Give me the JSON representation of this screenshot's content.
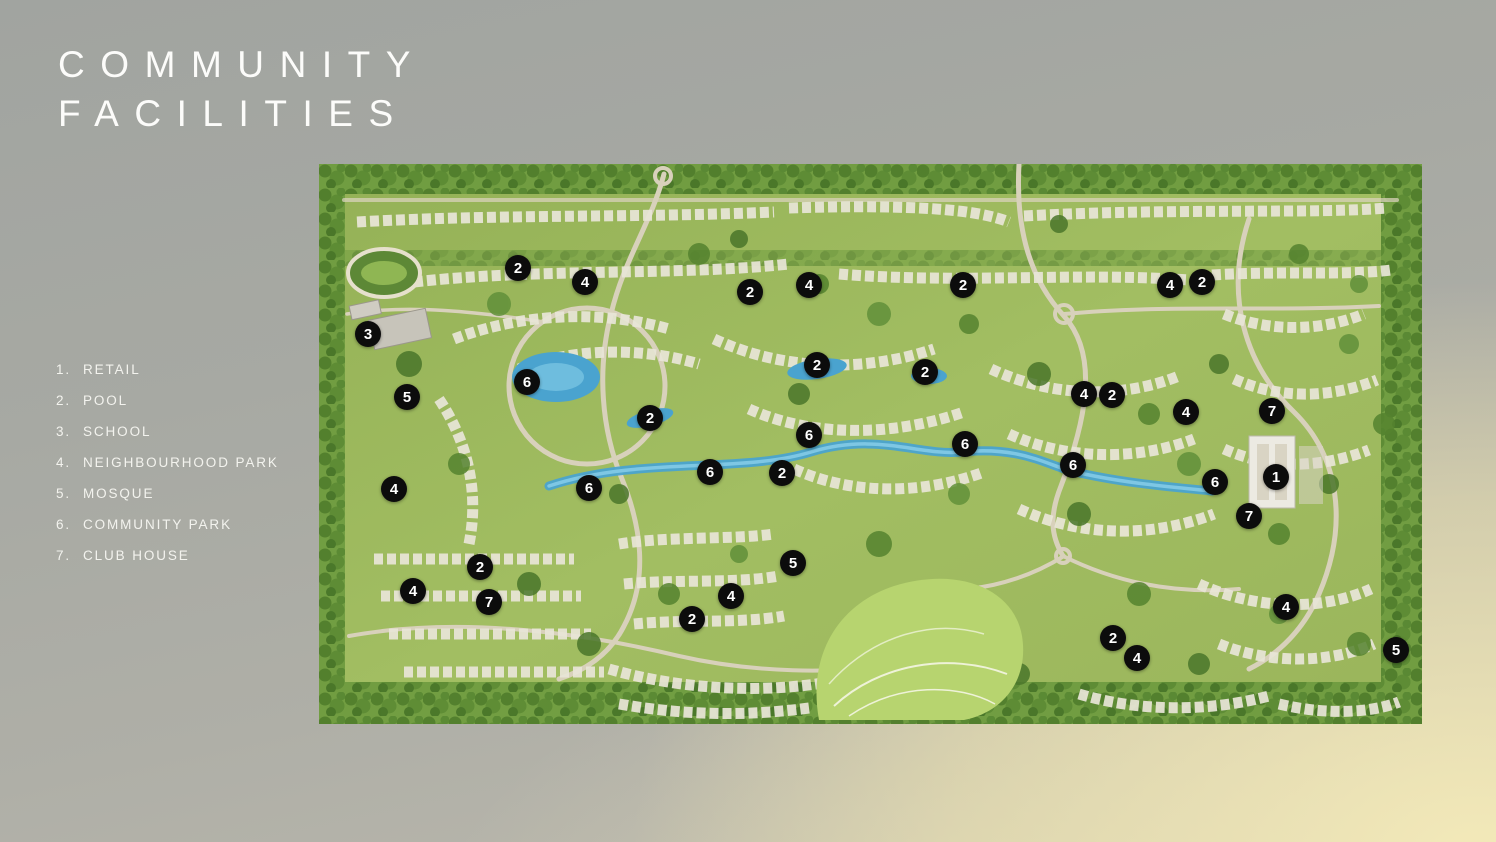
{
  "slide": {
    "title_line1": "COMMUNITY",
    "title_line2": "FACILITIES"
  },
  "legend": {
    "items": [
      {
        "num": "1",
        "label": "RETAIL"
      },
      {
        "num": "2",
        "label": "POOL"
      },
      {
        "num": "3",
        "label": "SCHOOL"
      },
      {
        "num": "4",
        "label": "NEIGHBOURHOOD PARK"
      },
      {
        "num": "5",
        "label": "MOSQUE"
      },
      {
        "num": "6",
        "label": "COMMUNITY PARK"
      },
      {
        "num": "7",
        "label": "CLUB HOUSE"
      }
    ]
  },
  "map": {
    "description": "Aerial masterplan render of the community with numbered facility markers",
    "markers": [
      {
        "num": "2",
        "x": 518,
        "y": 268
      },
      {
        "num": "4",
        "x": 585,
        "y": 282
      },
      {
        "num": "2",
        "x": 750,
        "y": 292
      },
      {
        "num": "4",
        "x": 809,
        "y": 285
      },
      {
        "num": "2",
        "x": 963,
        "y": 285
      },
      {
        "num": "4",
        "x": 1170,
        "y": 285
      },
      {
        "num": "2",
        "x": 1202,
        "y": 282
      },
      {
        "num": "3",
        "x": 368,
        "y": 334
      },
      {
        "num": "2",
        "x": 817,
        "y": 365
      },
      {
        "num": "2",
        "x": 925,
        "y": 372
      },
      {
        "num": "6",
        "x": 527,
        "y": 382
      },
      {
        "num": "4",
        "x": 1084,
        "y": 394
      },
      {
        "num": "2",
        "x": 1112,
        "y": 395
      },
      {
        "num": "5",
        "x": 407,
        "y": 397
      },
      {
        "num": "7",
        "x": 1272,
        "y": 411
      },
      {
        "num": "4",
        "x": 1186,
        "y": 412
      },
      {
        "num": "2",
        "x": 650,
        "y": 418
      },
      {
        "num": "6",
        "x": 809,
        "y": 435
      },
      {
        "num": "6",
        "x": 965,
        "y": 444
      },
      {
        "num": "6",
        "x": 1073,
        "y": 465
      },
      {
        "num": "6",
        "x": 710,
        "y": 472
      },
      {
        "num": "2",
        "x": 782,
        "y": 473
      },
      {
        "num": "1",
        "x": 1276,
        "y": 477
      },
      {
        "num": "6",
        "x": 1215,
        "y": 482
      },
      {
        "num": "6",
        "x": 589,
        "y": 488
      },
      {
        "num": "4",
        "x": 394,
        "y": 489
      },
      {
        "num": "7",
        "x": 1249,
        "y": 516
      },
      {
        "num": "5",
        "x": 793,
        "y": 563
      },
      {
        "num": "2",
        "x": 480,
        "y": 567
      },
      {
        "num": "4",
        "x": 413,
        "y": 591
      },
      {
        "num": "4",
        "x": 731,
        "y": 596
      },
      {
        "num": "7",
        "x": 489,
        "y": 602
      },
      {
        "num": "4",
        "x": 1286,
        "y": 607
      },
      {
        "num": "2",
        "x": 692,
        "y": 619
      },
      {
        "num": "2",
        "x": 1113,
        "y": 638
      },
      {
        "num": "5",
        "x": 1396,
        "y": 650
      },
      {
        "num": "4",
        "x": 1137,
        "y": 658
      }
    ]
  },
  "colors": {
    "marker_bg": "#0c0c0c",
    "marker_text": "#ffffff",
    "title_text": "#fcfcfa",
    "legend_text": "#f3f3ee",
    "bg_gray": "#a4a6a1",
    "bg_cream": "#f0e9c2",
    "map_green": "#9cb75d",
    "map_trees": "#4f7d2b",
    "map_water": "#4aa3cf",
    "map_roads": "#d8d1bb",
    "map_houses": "#eceade"
  }
}
